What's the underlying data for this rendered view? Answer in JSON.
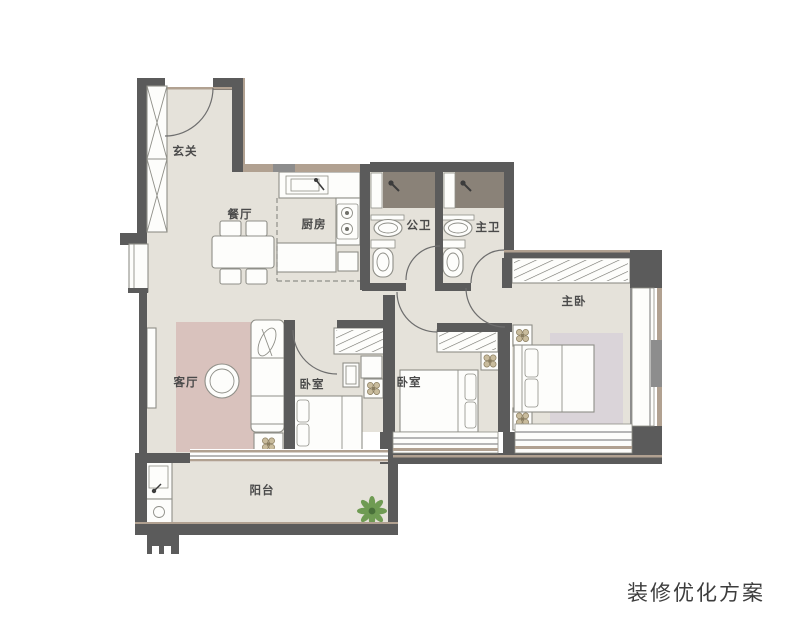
{
  "caption": "装修优化方案",
  "rooms": {
    "entry": {
      "label": "玄关"
    },
    "dining": {
      "label": "餐厅"
    },
    "kitchen": {
      "label": "厨房"
    },
    "bath_guest": {
      "label": "公卫"
    },
    "bath_master": {
      "label": "主卫"
    },
    "master_bedroom": {
      "label": "主卧"
    },
    "living": {
      "label": "客厅"
    },
    "bedroom_a": {
      "label": "卧室"
    },
    "bedroom_b": {
      "label": "卧室"
    },
    "balcony": {
      "label": "阳台"
    }
  },
  "icons": {
    "shower": "shower-head-icon",
    "plant": "potted-plant-icon",
    "medallion": "flower-medallion-icon",
    "faucet": "faucet-icon"
  },
  "colors": {
    "wall": "#5b5b5b",
    "wall-mid": "#8d8d8d",
    "frame": "#b1a191",
    "floor": "#e5e2da",
    "rug-living": "#d9c2bd",
    "rug-master": "#dad4d9",
    "shower": "#8a8278",
    "furn-fill": "#fdfdfb",
    "furn-stroke": "#8f8f88",
    "door": "#6e6e6e",
    "dash": "#8f8f89",
    "hatch": "#6f6f69",
    "plant-green": "#6f9b53",
    "plant-dark": "#49703a",
    "medallion-beige": "#c9bc9d",
    "medallion-dark": "#8a7d5f",
    "text": "#4a4a4a",
    "caption": "#3d3d3d"
  }
}
